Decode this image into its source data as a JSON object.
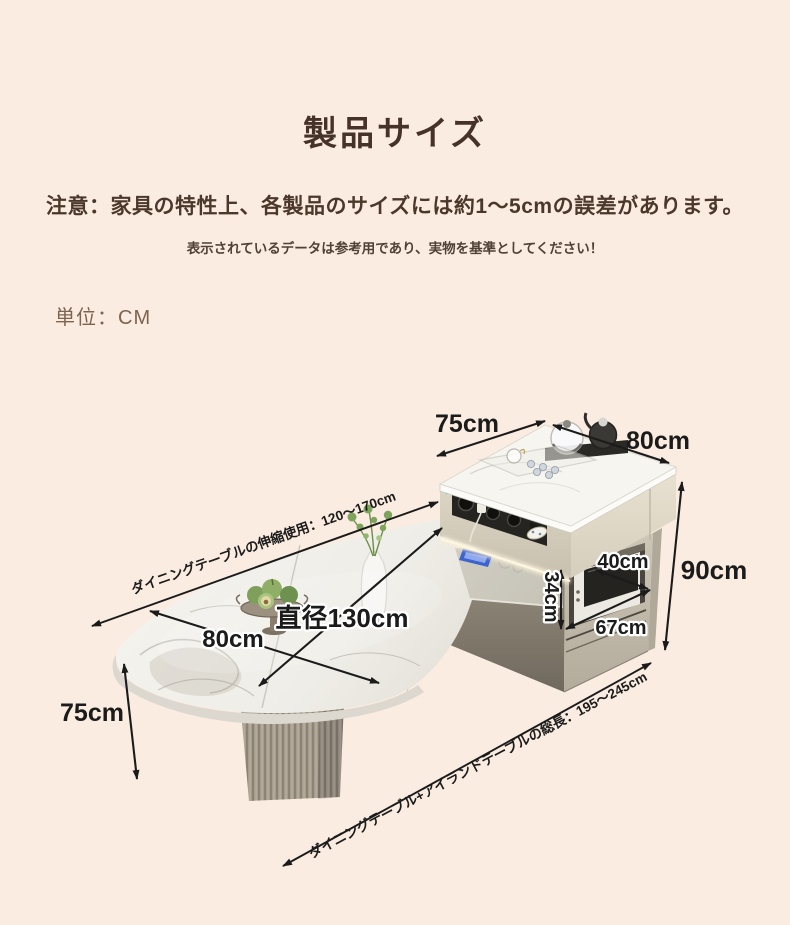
{
  "header": {
    "title": "製品サイズ",
    "notice": "注意：家具の特性上、各製品のサイズには約1〜5cmの誤差があります。",
    "notice_sub": "表示されているデータは参考用であり、実物を基準としてください！",
    "unit_label": "単位：CM"
  },
  "diagram": {
    "labels": {
      "island_top_depth": "75cm",
      "island_top_width": "80cm",
      "island_height": "90cm",
      "niche_depth": "40cm",
      "niche_height": "34cm",
      "niche_width": "67cm",
      "table_diameter": "直径130cm",
      "table_depth": "80cm",
      "table_height": "75cm",
      "extension_note": "ダイニングテーブルの伸縮使用：120〜170cm",
      "total_length_note": "ダイニングテーブル+アイランドテーブルの総長：195〜245cm"
    },
    "colors": {
      "background": "#faece0",
      "title_text": "#463228",
      "notice_text": "#4b372c",
      "unit_text": "#7e6450",
      "annotation_ink": "#1b1b1b",
      "marble": "#f4f2ec",
      "island_body": "#d8d1c1",
      "cabinet": "#c6bfb0",
      "pedestal": "#a29a8c",
      "led_glow": "#f8eed4",
      "microwave_window": "#242320",
      "plant_green": "#7da35c",
      "phone_blue": "#3d63cc"
    }
  }
}
